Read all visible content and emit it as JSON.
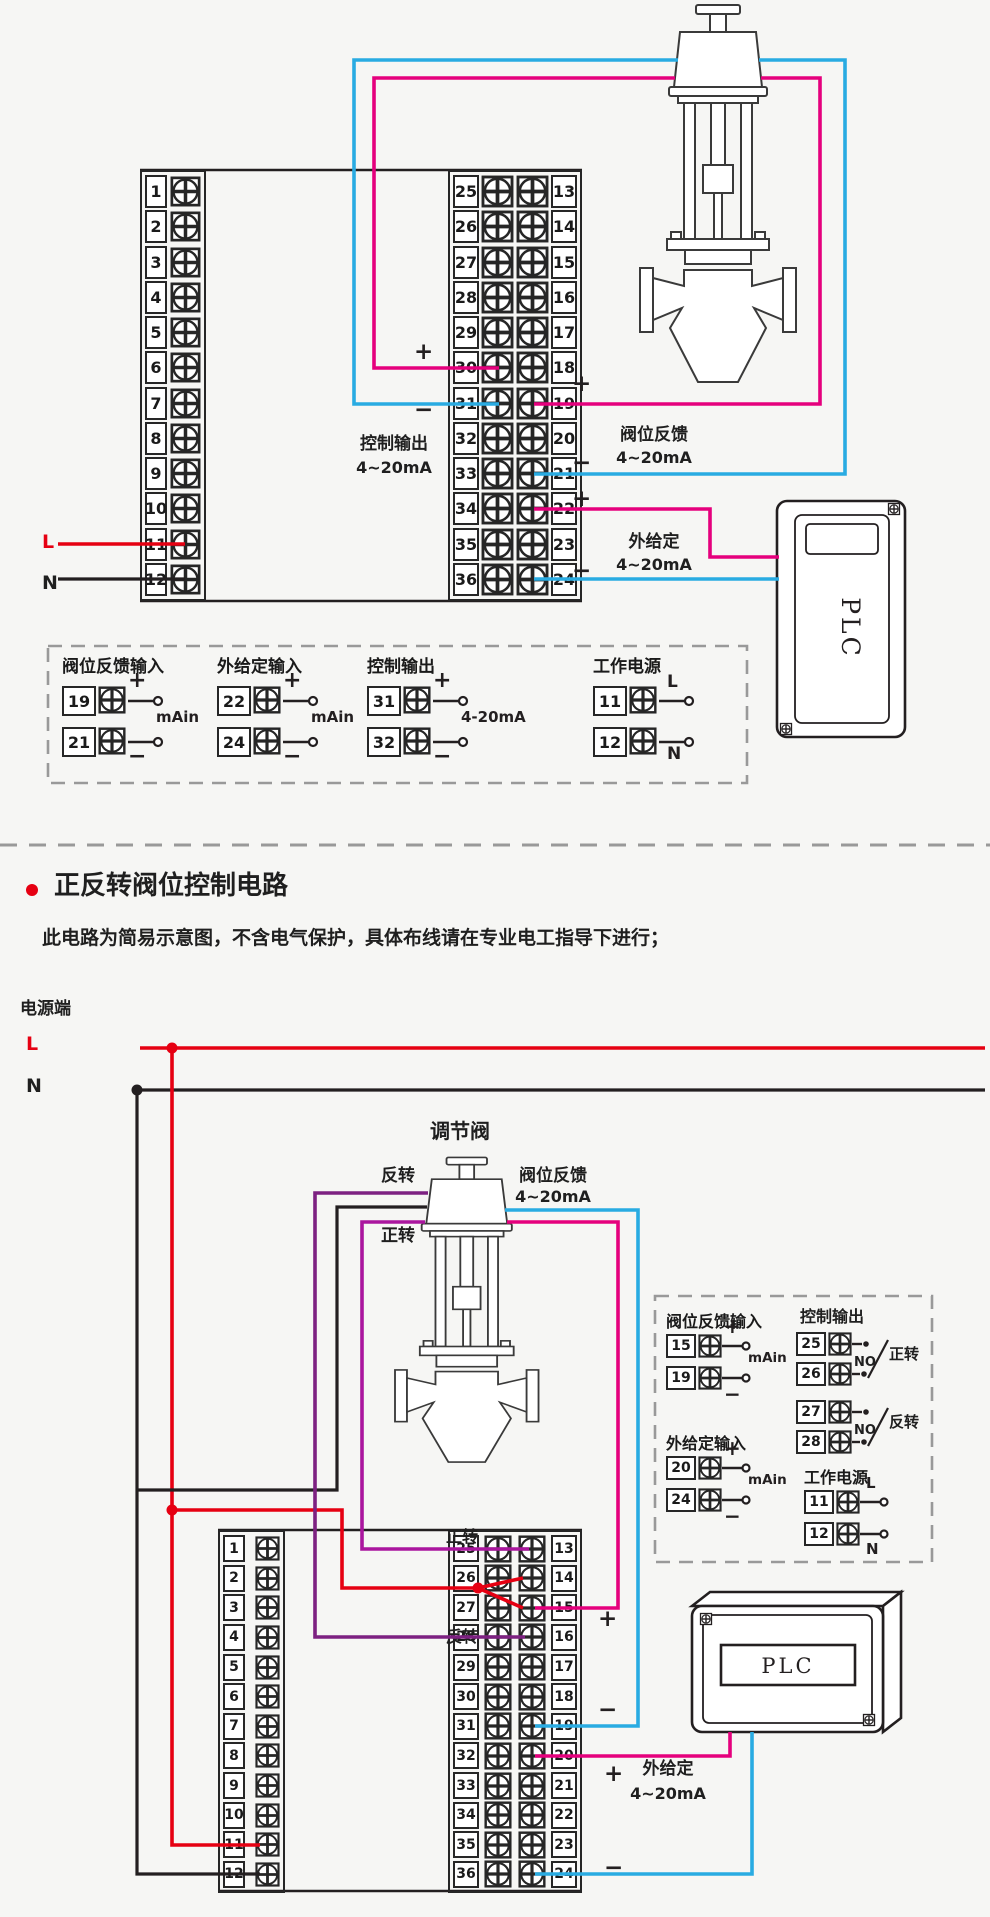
{
  "colors": {
    "background": "#f6f6f4",
    "wire_red": "#e60012",
    "wire_blue": "#29abe2",
    "wire_magenta": "#e5007d",
    "wire_purple": "#7d2181",
    "wire_violet": "#aa169e",
    "line_dark": "#231f20",
    "dash_gray": "#999999"
  },
  "signs": {
    "plus": "+",
    "minus": "−",
    "L": "L",
    "N": "N"
  },
  "section1": {
    "left_terminals": [
      "1",
      "2",
      "3",
      "4",
      "5",
      "6",
      "7",
      "8",
      "9",
      "10",
      "11",
      "12"
    ],
    "middle_terminals_left": [
      "25",
      "26",
      "27",
      "28",
      "29",
      "30",
      "31",
      "32",
      "33",
      "34",
      "35",
      "36"
    ],
    "middle_terminals_right": [
      "13",
      "14",
      "15",
      "16",
      "17",
      "18",
      "19",
      "20",
      "21",
      "22",
      "23",
      "24"
    ],
    "power_L": "L",
    "power_N": "N",
    "control_output_label": "控制输出",
    "control_output_range": "4~20mA",
    "valve_feedback_label": "阀位反馈",
    "valve_feedback_range": "4~20mA",
    "external_setpoint_label": "外给定",
    "external_setpoint_range": "4~20mA",
    "plc_label": "PLC",
    "legend": {
      "groups": [
        {
          "title": "阀位反馈输入",
          "rows": [
            {
              "terminal": "19",
              "sign": "+"
            },
            {
              "terminal": "21",
              "sign": "−"
            }
          ],
          "annotation": "mAin"
        },
        {
          "title": "外给定输入",
          "rows": [
            {
              "terminal": "22",
              "sign": "+"
            },
            {
              "terminal": "24",
              "sign": "−"
            }
          ],
          "annotation": "mAin"
        },
        {
          "title": "控制输出",
          "rows": [
            {
              "terminal": "31",
              "sign": "+"
            },
            {
              "terminal": "32",
              "sign": "−"
            }
          ],
          "annotation": "4-20mA"
        },
        {
          "title": "工作电源",
          "rows": [
            {
              "terminal": "11",
              "sign": "L"
            },
            {
              "termin al": "x",
              "terminal": "12",
              "sign": "N"
            }
          ],
          "annotation": ""
        }
      ]
    }
  },
  "section2": {
    "title": "正反转阀位控制电路",
    "subtitle": "此电路为简易示意图，不含电气保护，具体布线请在专业电工指导下进行；",
    "power_terminal_label": "电源端",
    "power_L": "L",
    "power_N": "N",
    "valve_label": "调节阀",
    "forward_label": "正转",
    "reverse_label": "反转",
    "valve_feedback_label": "阀位反馈",
    "valve_feedback_range": "4~20mA",
    "external_setpoint_label": "外给定",
    "external_setpoint_range": "4~20mA",
    "plc_label": "PLC",
    "left_terminals": [
      "1",
      "2",
      "3",
      "4",
      "5",
      "6",
      "7",
      "8",
      "9",
      "10",
      "11",
      "12"
    ],
    "middle_terminals_left": [
      "25",
      "26",
      "27",
      "28",
      "29",
      "30",
      "31",
      "32",
      "33",
      "34",
      "35",
      "36"
    ],
    "middle_terminals_right": [
      "13",
      "14",
      "15",
      "16",
      "17",
      "18",
      "19",
      "20",
      "21",
      "22",
      "23",
      "24"
    ],
    "legend": {
      "feedback": {
        "title": "阀位反馈输入",
        "rows": [
          {
            "terminal": "15",
            "sign": "+"
          },
          {
            "terminal": "19",
            "sign": "−"
          }
        ],
        "annotation": "mAin"
      },
      "setpoint": {
        "title": "外给定输入",
        "rows": [
          {
            "terminal": "20",
            "sign": "+"
          },
          {
            "terminal": "24",
            "sign": "−"
          }
        ],
        "annotation": "mAin"
      },
      "control": {
        "title": "控制输出",
        "relays": [
          {
            "top": "25",
            "bottom": "26",
            "contact": "NO",
            "label": "正转"
          },
          {
            "top": "27",
            "bottom": "28",
            "contact": "NO",
            "label": "反转"
          }
        ]
      },
      "power": {
        "title": "工作电源",
        "rows": [
          {
            "terminal": "11",
            "sign": "L"
          },
          {
            "terminal": "12",
            "sign": "N"
          }
        ]
      }
    }
  }
}
